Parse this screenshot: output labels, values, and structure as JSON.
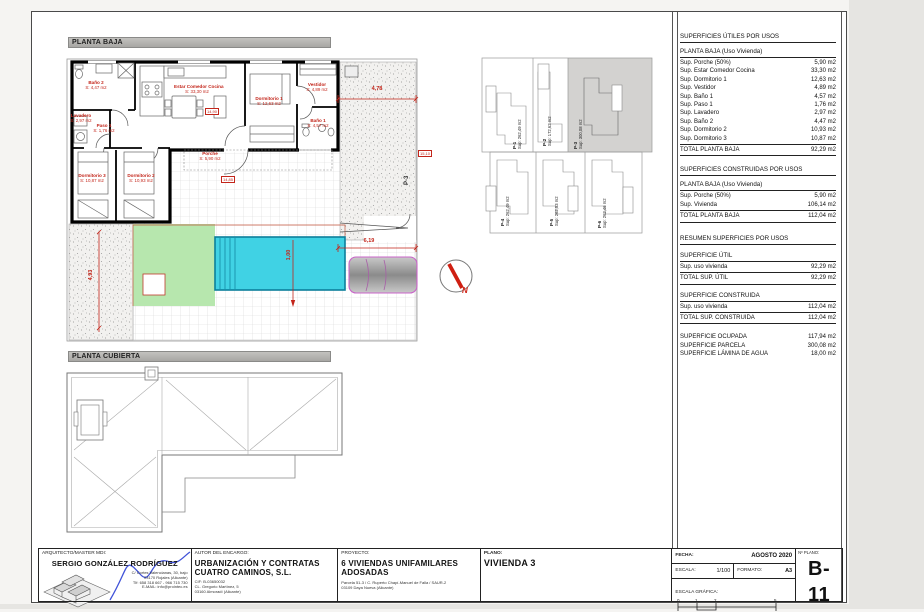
{
  "labels": {
    "planta_baja": "PLANTA BAJA",
    "planta_cubierta": "PLANTA CUBIERTA"
  },
  "plan": {
    "rooms": [
      {
        "name": "Baño 2",
        "area": "S: 4,47 m2"
      },
      {
        "name": "Lavadero",
        "area": "S: 2,97 m2"
      },
      {
        "name": "Paso 1",
        "area": "S: 1,76 m2"
      },
      {
        "name": "Estar Comedor Cocina",
        "area": "S: 33,30 m2"
      },
      {
        "name": "Dormitorio 1",
        "area": "S: 12,63 m2"
      },
      {
        "name": "Vestidor",
        "area": "S: 4,89 m2"
      },
      {
        "name": "Baño 1",
        "area": "S: 4,57 m2"
      },
      {
        "name": "Dormitorio 3",
        "area": "S: 10,87 m2"
      },
      {
        "name": "Dormitorio 2",
        "area": "S: 10,93 m2"
      },
      {
        "name": "Porche",
        "area": "S: 5,90 m2"
      }
    ],
    "dims": {
      "top": "4,78",
      "gate": "6,19",
      "pool": "1,00",
      "left": "4,93"
    },
    "levels": {
      "living": "14,90",
      "terrace": "14,85",
      "entry": "15,10"
    },
    "gate_label": "P-3",
    "north": "N"
  },
  "site_plan": {
    "parcels": [
      {
        "id": "P-1",
        "sup": "Sup: 262,49 m2"
      },
      {
        "id": "P-2",
        "sup": "Sup: 172,62 m2"
      },
      {
        "id": "P-3",
        "sup": "Sup: 300,08 m2"
      },
      {
        "id": "P-4",
        "sup": "Sup: 262,49 m2"
      },
      {
        "id": "P-5",
        "sup": "Sup: 262,53 m2"
      },
      {
        "id": "P-6",
        "sup": "Sup: 262,46 m2"
      }
    ]
  },
  "tables": {
    "utiles": {
      "title": "SUPERFICIES ÚTILES POR USOS",
      "subtitle": "PLANTA BAJA (Uso Vivienda)",
      "rows": [
        {
          "label": "Sup. Porche (50%)",
          "value": "5,90 m2"
        },
        {
          "label": "Sup. Estar Comedor Cocina",
          "value": "33,30 m2"
        },
        {
          "label": "Sup. Dormitorio 1",
          "value": "12,63 m2"
        },
        {
          "label": "Sup. Vestidor",
          "value": "4,89 m2"
        },
        {
          "label": "Sup. Baño 1",
          "value": "4,57 m2"
        },
        {
          "label": "Sup. Paso 1",
          "value": "1,76 m2"
        },
        {
          "label": "Sup. Lavadero",
          "value": "2,97 m2"
        },
        {
          "label": "Sup. Baño 2",
          "value": "4,47 m2"
        },
        {
          "label": "Sup. Dormitorio 2",
          "value": "10,93 m2"
        },
        {
          "label": "Sup. Dormitorio 3",
          "value": "10,87 m2"
        }
      ],
      "total": {
        "label": "TOTAL PLANTA BAJA",
        "value": "92,29 m2"
      }
    },
    "construidas": {
      "title": "SUPERFICIES CONSTRUIDAS POR USOS",
      "subtitle": "PLANTA BAJA (Uso Vivienda)",
      "rows": [
        {
          "label": "Sup. Porche (50%)",
          "value": "5,90 m2"
        },
        {
          "label": "Sup. Vivienda",
          "value": "106,14 m2"
        }
      ],
      "total": {
        "label": "TOTAL PLANTA BAJA",
        "value": "112,04 m2"
      }
    },
    "resumen": {
      "title": "RESUMEN SUPERFICIES POR USOS",
      "util_header": "SUPERFICIE ÚTIL",
      "util_row": {
        "label": "Sup. uso vivienda",
        "value": "92,29 m2"
      },
      "util_total": {
        "label": "TOTAL SUP. ÚTIL",
        "value": "92,29 m2"
      },
      "const_header": "SUPERFICIE CONSTRUIDA",
      "const_row": {
        "label": "Sup. uso vivienda",
        "value": "112,04 m2"
      },
      "const_total": {
        "label": "TOTAL SUP. CONSTRUIDA",
        "value": "112,04 m2"
      },
      "extra": [
        {
          "label": "SUPERFICIE OCUPADA",
          "value": "117,94 m2"
        },
        {
          "label": "SUPERFICIE PARCELA",
          "value": "300,08 m2"
        },
        {
          "label": "SUPERFICIE LÁMINA DE AGUA",
          "value": "18,00 m2"
        }
      ]
    }
  },
  "titleblock": {
    "architect": {
      "label": "ARQUITECTO/MASTER MDI:",
      "name": "SERGIO GONZÁLEZ RODRÍGUEZ",
      "address1": "C/ Cortes Valencianas, 30, bajo",
      "address2": "03170 Rojales (Alicante)",
      "address3": "Tlf: 658 318 667 - 966 715 730",
      "address4": "E-MAIL: info@prointec.es"
    },
    "client": {
      "label": "AUTOR DEL ENCARGO:",
      "name1": "URBANIZACIÓN Y CONTRATAS",
      "name2": "CUATRO CAMINOS, S.L.",
      "line1": "CIF: B-03650032",
      "line2": "CL. Gregorio Martínez, 5",
      "line3": "03160 Almoradí (Alicante)"
    },
    "project": {
      "label": "PROYECTO:",
      "name1": "6 VIVIENDAS UNIFAMILARES",
      "name2": "ADOSADAS",
      "line1": "Parcela 51-3 / C. Ruperto Chapí-Manuel de Falla / SAUR-2",
      "line2": "03109 Daya Nueva (Alicante)"
    },
    "plano": {
      "label": "PLANO:",
      "name": "VIVIENDA 3"
    },
    "meta": {
      "fecha_label": "FECHA:",
      "fecha": "AGOSTO 2020",
      "escala_label": "ESCALA:",
      "escala": "1/100",
      "formato_label": "FORMATO:",
      "formato": "A3",
      "grafica_label": "ESCALA GRÁFICA:",
      "scale_ticks": [
        "0",
        "1",
        "2",
        "5"
      ]
    },
    "numero": {
      "label": "Nº PLANO:",
      "value": "B-11"
    }
  }
}
